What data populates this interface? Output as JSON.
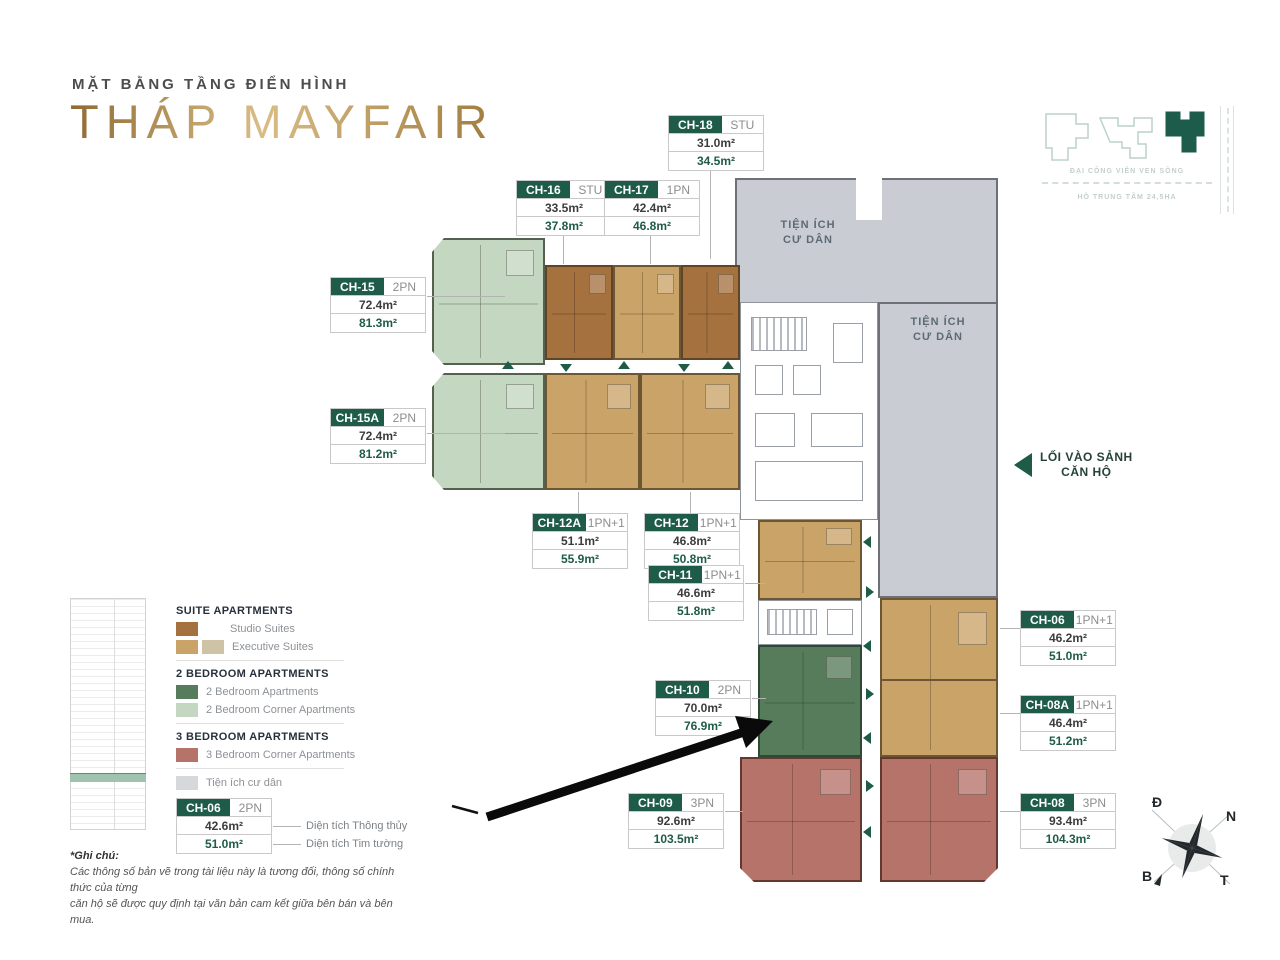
{
  "header": {
    "kicker": "MẶT BẰNG TẦNG ĐIỂN HÌNH",
    "title": "THÁP MAYFAIR"
  },
  "minimap": {
    "caption_top": "ĐẠI CÔNG VIÊN VEN SÔNG",
    "caption_bottom": "HỒ TRUNG TÂM 24,5HA"
  },
  "plan": {
    "amenity_line1": "TIỆN ÍCH",
    "amenity_line2": "CƯ DÂN",
    "entrance_line1": "LỐI VÀO SẢNH",
    "entrance_line2": "CĂN HỘ"
  },
  "units": [
    {
      "id": "CH-18",
      "type": "STU",
      "area_net": "31.0m²",
      "area_gross": "34.5m²"
    },
    {
      "id": "CH-16",
      "type": "STU",
      "area_net": "33.5m²",
      "area_gross": "37.8m²"
    },
    {
      "id": "CH-17",
      "type": "1PN",
      "area_net": "42.4m²",
      "area_gross": "46.8m²"
    },
    {
      "id": "CH-15",
      "type": "2PN",
      "area_net": "72.4m²",
      "area_gross": "81.3m²"
    },
    {
      "id": "CH-15A",
      "type": "2PN",
      "area_net": "72.4m²",
      "area_gross": "81.2m²"
    },
    {
      "id": "CH-12A",
      "type": "1PN+1",
      "area_net": "51.1m²",
      "area_gross": "55.9m²"
    },
    {
      "id": "CH-12",
      "type": "1PN+1",
      "area_net": "46.8m²",
      "area_gross": "50.8m²"
    },
    {
      "id": "CH-11",
      "type": "1PN+1",
      "area_net": "46.6m²",
      "area_gross": "51.8m²"
    },
    {
      "id": "CH-10",
      "type": "2PN",
      "area_net": "70.0m²",
      "area_gross": "76.9m²"
    },
    {
      "id": "CH-09",
      "type": "3PN",
      "area_net": "92.6m²",
      "area_gross": "103.5m²"
    },
    {
      "id": "CH-06",
      "type": "1PN+1",
      "area_net": "46.2m²",
      "area_gross": "51.0m²"
    },
    {
      "id": "CH-08A",
      "type": "1PN+1",
      "area_net": "46.4m²",
      "area_gross": "51.2m²"
    },
    {
      "id": "CH-08",
      "type": "3PN",
      "area_net": "93.4m²",
      "area_gross": "104.3m²"
    }
  ],
  "legend": {
    "sections": [
      {
        "title": "SUITE APARTMENTS",
        "items": [
          {
            "label": "Studio Suites"
          },
          {
            "label": "Executive Suites"
          }
        ]
      },
      {
        "title": "2 BEDROOM APARTMENTS",
        "items": [
          {
            "label": "2 Bedroom Apartments"
          },
          {
            "label": "2 Bedroom Corner Apartments"
          }
        ]
      },
      {
        "title": "3 BEDROOM APARTMENTS",
        "items": [
          {
            "label": "3 Bedroom Corner Apartments"
          }
        ]
      }
    ],
    "amenity_item": "Tiện ích cư dân",
    "sample": {
      "id": "CH-06",
      "type": "2PN",
      "area_net": "42.6m²",
      "area_gross": "51.0m²",
      "net_label": "Diện tích Thông thủy",
      "gross_label": "Diện tích Tim tường"
    }
  },
  "note": {
    "title": "*Ghi chú:",
    "line1": "Các thông số bản vẽ trong tài liệu này là tương đối, thông số chính thức của từng",
    "line2": "căn hộ sẽ được quy định tại văn bản cam kết giữa bên bán và bên mua."
  },
  "compass": {
    "top_left": "Đ",
    "top_right": "N",
    "bottom_left": "B",
    "bottom_right": "T"
  },
  "colors": {
    "gold": "#b9914f",
    "labelgreen": "#1e5b48",
    "studio": "#a5713f",
    "exec": "#c9a368",
    "exec2": "#cfc3a5",
    "g2br": "#567c5c",
    "g2brc": "#c3d7c1",
    "r3br": "#b5736a",
    "amen": "#c9cdd3"
  }
}
